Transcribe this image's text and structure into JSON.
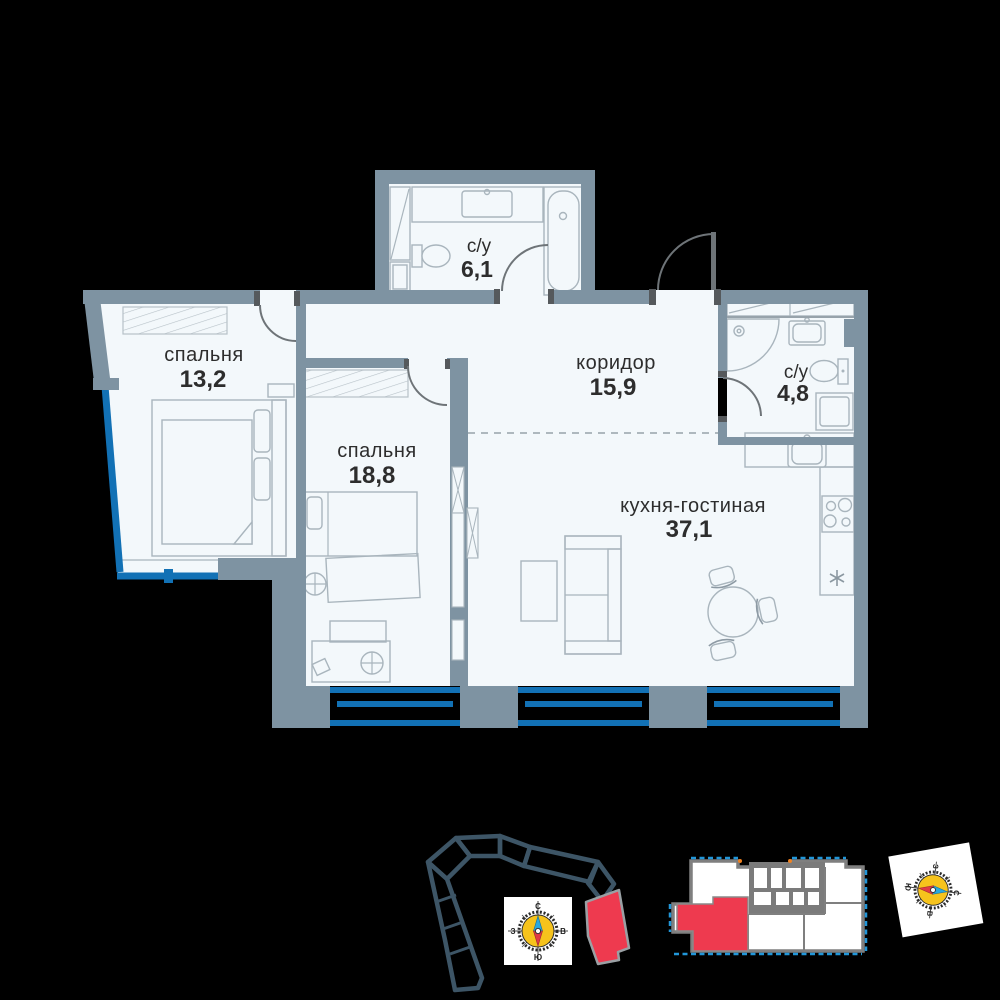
{
  "rooms": {
    "bedroom1": {
      "label": "спальня",
      "area": "13,2"
    },
    "bedroom2": {
      "label": "спальня",
      "area": "18,8"
    },
    "bathroom1": {
      "label": "с/у",
      "area": "6,1"
    },
    "corridor": {
      "label": "коридор",
      "area": "15,9"
    },
    "bathroom2": {
      "label": "с/у",
      "area": "4,8"
    },
    "kitchen_living": {
      "label": "кухня-гостиная",
      "area": "37,1"
    }
  },
  "compass": {
    "north": "С",
    "south": "Ю",
    "west": "З",
    "east": "В"
  },
  "colors": {
    "wall": "#7e93a2",
    "floor": "#f3f8fb",
    "window_blue": "#1271b5",
    "highlight_red": "#ee3a4f",
    "compass_yellow": "#f6c31c",
    "site_outline": "#3d5566",
    "mini_gray": "#7f7f7f"
  }
}
